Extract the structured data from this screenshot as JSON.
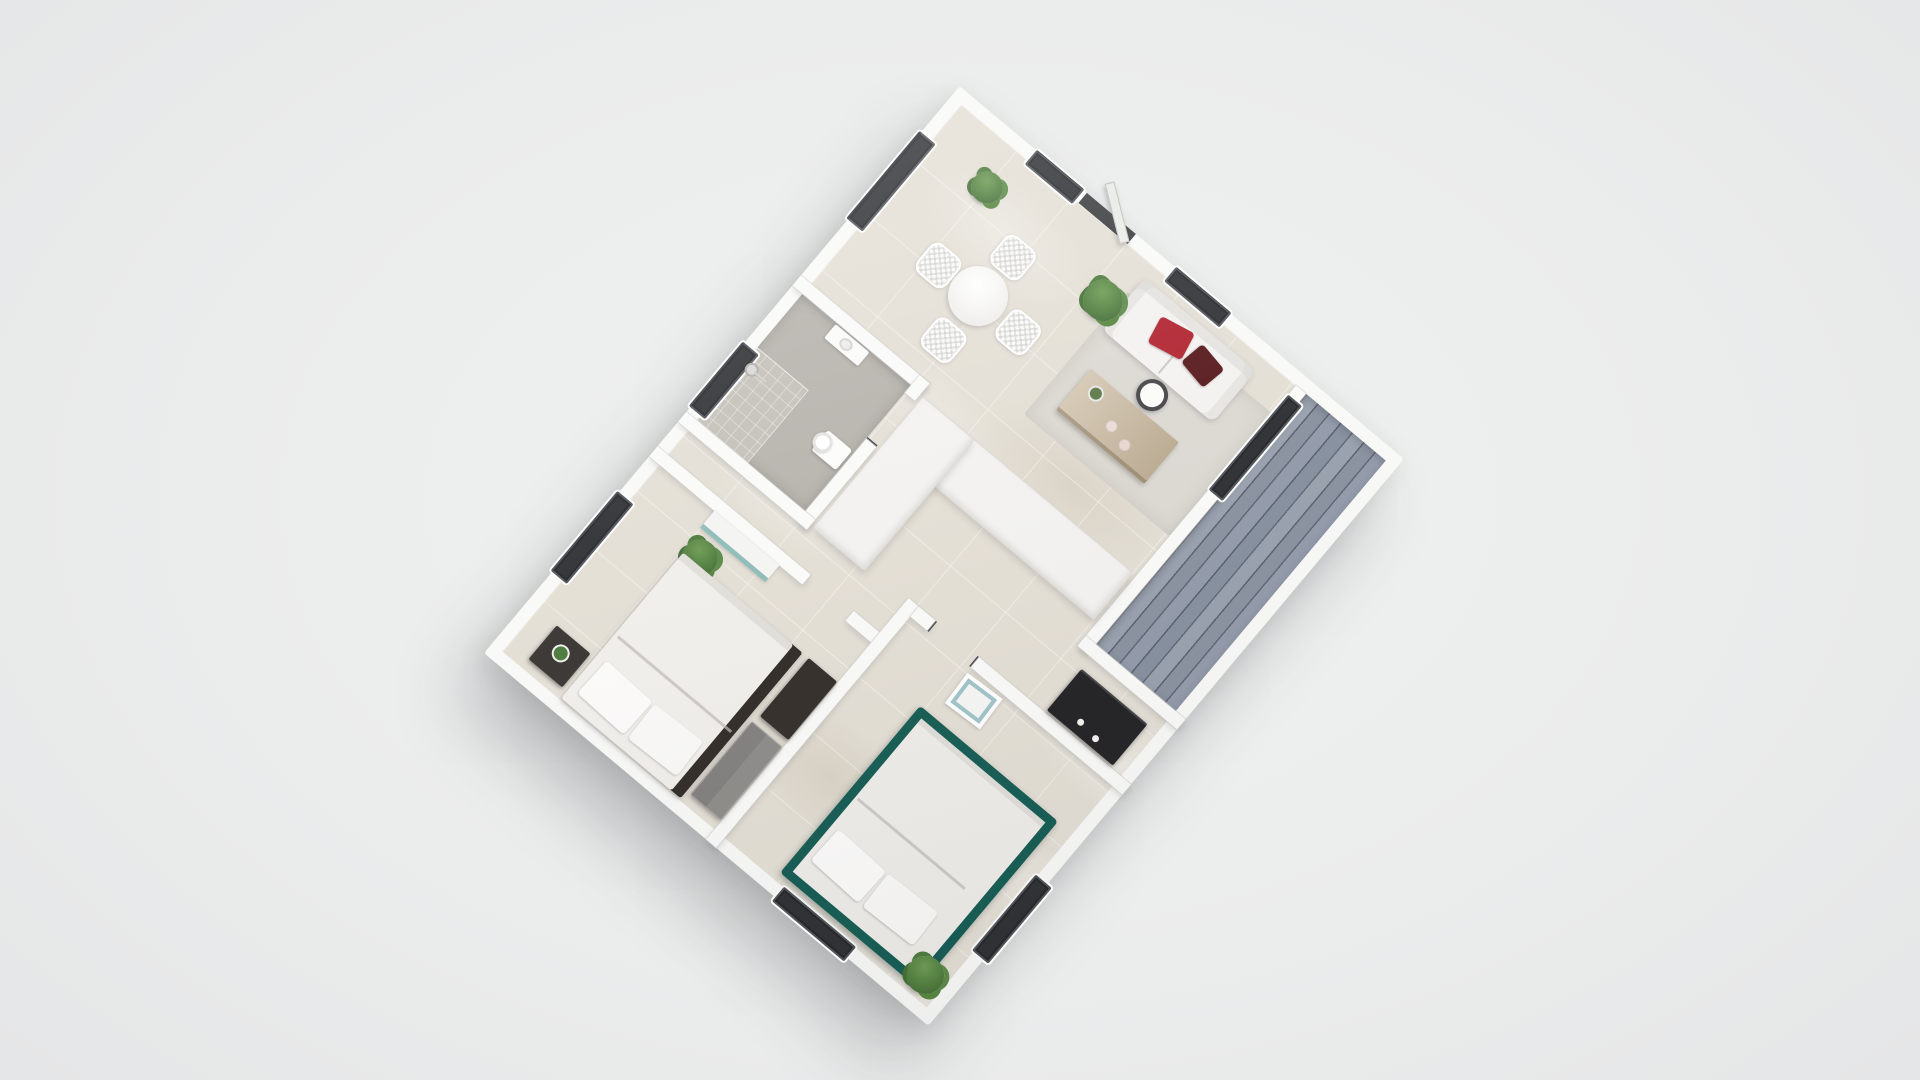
{
  "scene": {
    "description": "3D rendered isometric floor plan of a small apartment, viewed from above, rotated about 40 degrees, on a plain light gray background",
    "background_color": "#ebecec",
    "no_visible_text": true
  },
  "palette": {
    "wall": "#fafaf9",
    "floor_tile": "#e4dfd5",
    "rug": "#dcd9d3",
    "balcony_plank": "#8c94a1",
    "bathroom_floor": "#b7b3ad",
    "shower_floor": "#c4c0b9",
    "window_glass": "#2f3134",
    "sofa": "#f3f2f0",
    "pillow_red": "#b12430",
    "pillow_dark_red": "#571a1d",
    "coffee_table_wood": "#c7b69c",
    "drum_table": "#47474b",
    "bed1_duvet": "#f1efeb",
    "bed1_frame_dark": "#332d29",
    "bed2_duvet": "#efede9",
    "bed2_frame_teal": "#175d55",
    "dresser_gray": "#8e8d8a",
    "console_dark": "#242325",
    "nightstand_dark": "#3b3734",
    "wardrobe_teal": "#8fbdb8",
    "plant_green": "#4e7c3e"
  },
  "rooms": {
    "living_dining": {
      "label": "living and dining room"
    },
    "kitchen": {
      "label": "open kitchen"
    },
    "bathroom": {
      "label": "bathroom with shower and toilet"
    },
    "bedroom_1": {
      "label": "bedroom with white bed"
    },
    "bedroom_2": {
      "label": "bedroom with teal-framed bed"
    },
    "balcony": {
      "label": "balcony with wood plank decking"
    },
    "hallway": {
      "label": "hallway"
    }
  },
  "furniture": {
    "dining": {
      "table": "round white dining table",
      "chair_count": 4,
      "chair_style": "white wire chairs"
    },
    "living": {
      "sofa": "white two-seat sofa",
      "pillows": [
        "red pillow",
        "dark red pillow"
      ],
      "coffee_table": "light wood coffee table",
      "candle_count": 2,
      "side_table": "dark drum side table with white top",
      "plants": [
        "potted plant",
        "palm plant"
      ]
    },
    "kitchen_items": {
      "counter": "white L-shaped counter",
      "console": "dark cabinet with two knobs"
    },
    "bathroom_items": {
      "fixtures": [
        "shower",
        "toilet",
        "sink"
      ]
    },
    "bedroom_1_items": {
      "bed": "double bed with dark frame edge",
      "pillow_count": 2,
      "nightstand": "dark nightstand with small plant",
      "dresser": "gray dresser",
      "cabinet": "dark espresso cabinet",
      "wardrobe": "wardrobe with teal front",
      "plant": "potted plant"
    },
    "bedroom_2_items": {
      "bed": "double bed with dark teal frame",
      "pillow_count": 2,
      "art": "leaning picture frame",
      "plant": "potted plant"
    }
  },
  "openings": {
    "entry_door": "open door on the top-right wall with dark frame",
    "balcony_door": "dark glass door between living room and balcony",
    "window_count": 8
  }
}
